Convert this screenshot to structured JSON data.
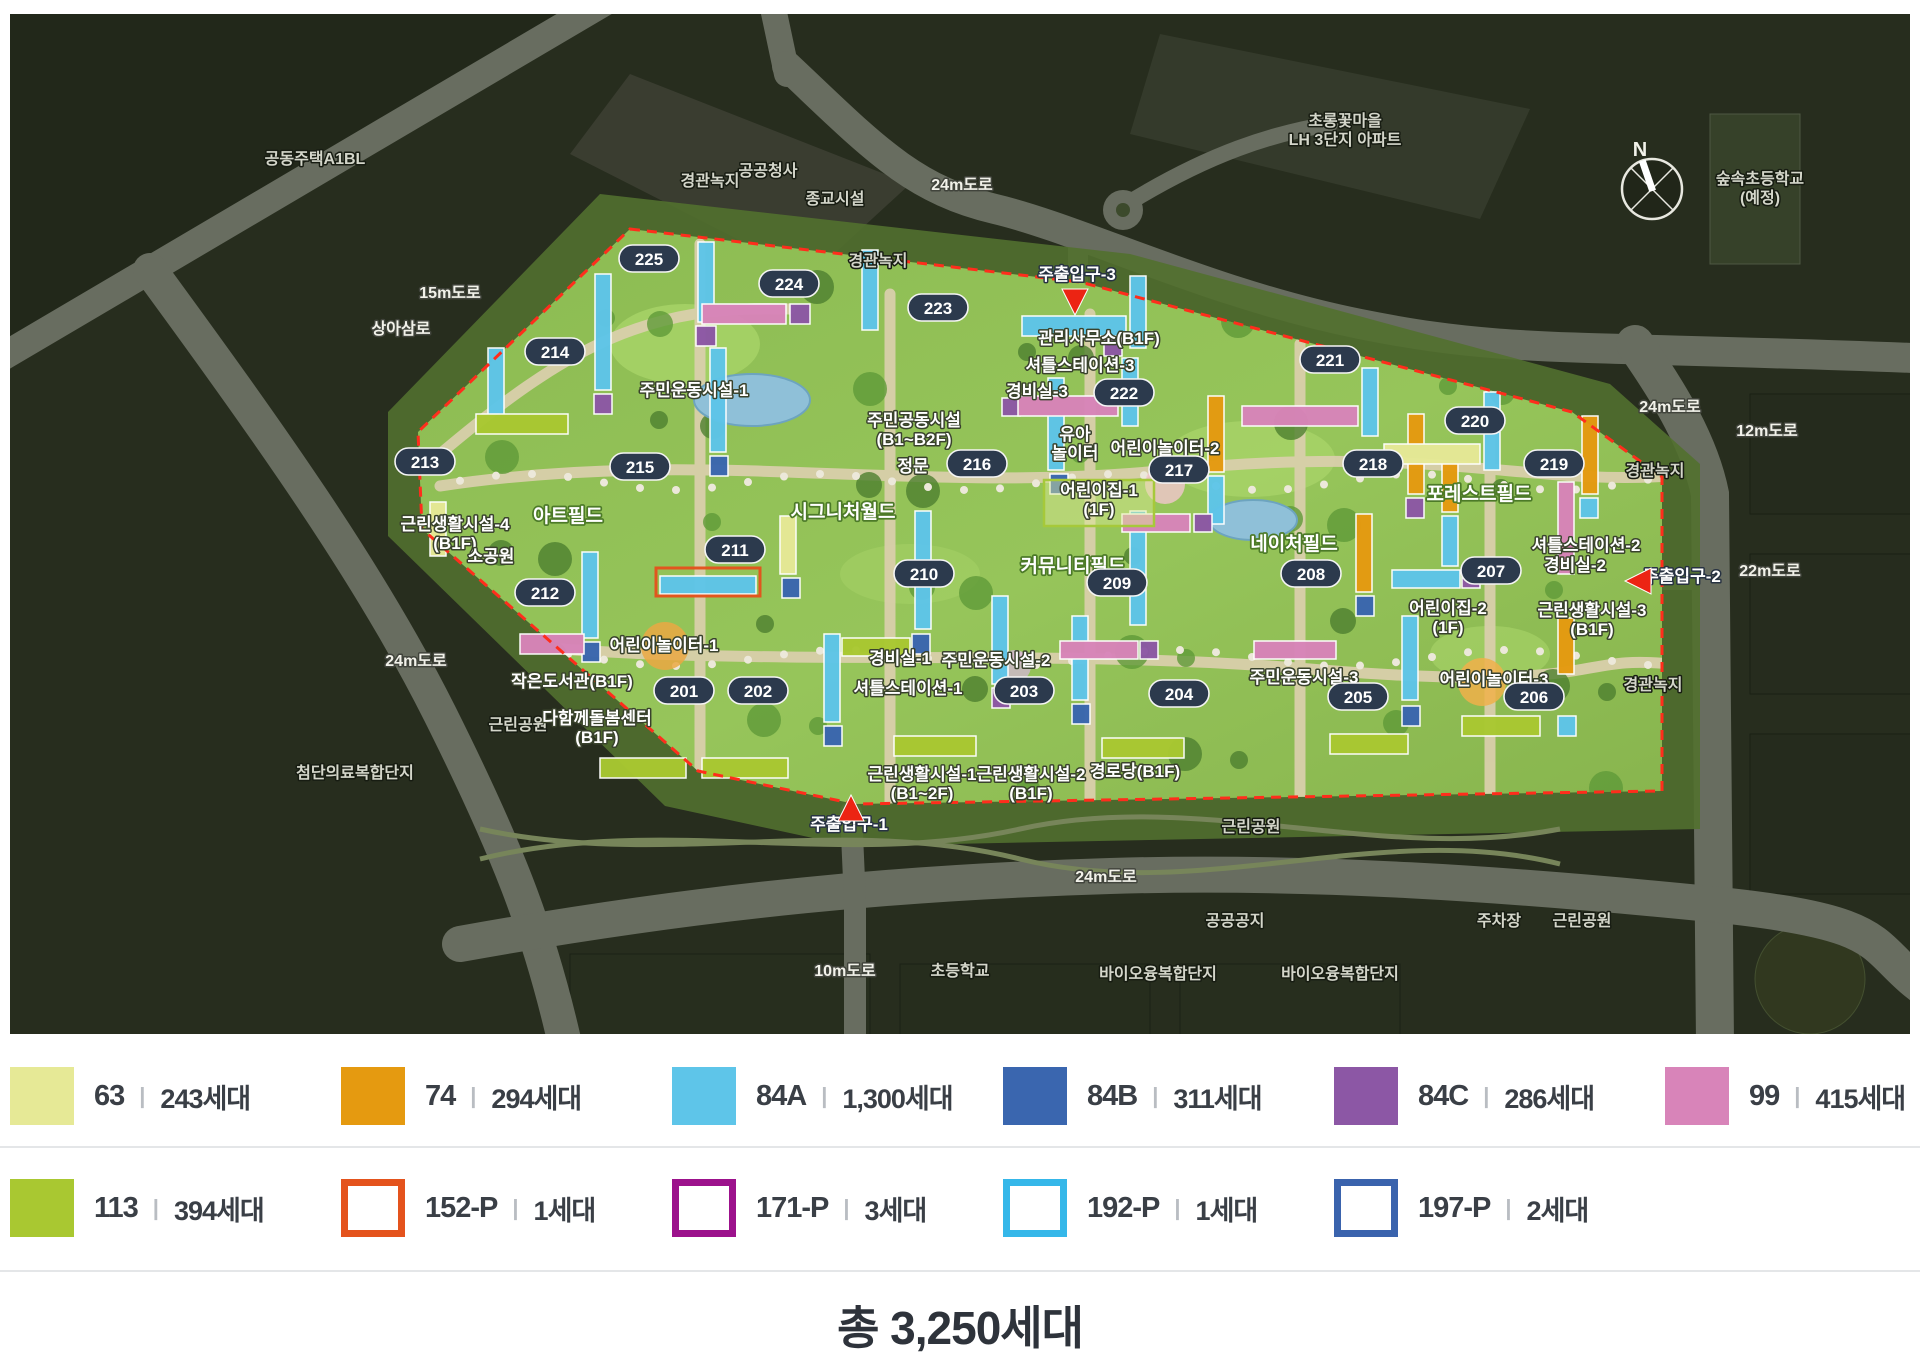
{
  "total": "총 3,250세대",
  "legend": {
    "separator": "|",
    "row1": [
      {
        "label": "63",
        "count": "243세대",
        "color": "#e6e996",
        "type": "fill"
      },
      {
        "label": "74",
        "count": "294세대",
        "color": "#e59a10",
        "type": "fill"
      },
      {
        "label": "84A",
        "count": "1,300세대",
        "color": "#5ec5e9",
        "type": "fill"
      },
      {
        "label": "84B",
        "count": "311세대",
        "color": "#3a66af",
        "type": "fill"
      },
      {
        "label": "84C",
        "count": "286세대",
        "color": "#8c57a5",
        "type": "fill"
      },
      {
        "label": "99",
        "count": "415세대",
        "color": "#d884b9",
        "type": "fill"
      }
    ],
    "row2": [
      {
        "label": "113",
        "count": "394세대",
        "color": "#a9c831",
        "type": "fill"
      },
      {
        "label": "152-P",
        "count": "1세대",
        "color": "#e4531d",
        "type": "outline"
      },
      {
        "label": "171-P",
        "count": "3세대",
        "color": "#9c128c",
        "type": "outline"
      },
      {
        "label": "192-P",
        "count": "1세대",
        "color": "#35b7e9",
        "type": "outline"
      },
      {
        "label": "197-P",
        "count": "2세대",
        "color": "#3a63ad",
        "type": "outline"
      }
    ]
  },
  "map": {
    "boundary_color": "#ff2d1c",
    "badge_color": "#2c3a4d",
    "badges": [
      {
        "n": "201",
        "x": 674,
        "y": 677
      },
      {
        "n": "202",
        "x": 748,
        "y": 677
      },
      {
        "n": "203",
        "x": 1014,
        "y": 677
      },
      {
        "n": "204",
        "x": 1169,
        "y": 680
      },
      {
        "n": "205",
        "x": 1348,
        "y": 683
      },
      {
        "n": "206",
        "x": 1524,
        "y": 683
      },
      {
        "n": "207",
        "x": 1481,
        "y": 557
      },
      {
        "n": "208",
        "x": 1301,
        "y": 560
      },
      {
        "n": "209",
        "x": 1107,
        "y": 569
      },
      {
        "n": "210",
        "x": 914,
        "y": 560
      },
      {
        "n": "211",
        "x": 725,
        "y": 536
      },
      {
        "n": "212",
        "x": 535,
        "y": 579
      },
      {
        "n": "213",
        "x": 415,
        "y": 448
      },
      {
        "n": "214",
        "x": 545,
        "y": 338
      },
      {
        "n": "215",
        "x": 630,
        "y": 453
      },
      {
        "n": "216",
        "x": 967,
        "y": 450
      },
      {
        "n": "217",
        "x": 1169,
        "y": 456
      },
      {
        "n": "218",
        "x": 1363,
        "y": 450
      },
      {
        "n": "219",
        "x": 1544,
        "y": 450
      },
      {
        "n": "220",
        "x": 1465,
        "y": 407
      },
      {
        "n": "221",
        "x": 1320,
        "y": 346
      },
      {
        "n": "222",
        "x": 1114,
        "y": 379
      },
      {
        "n": "223",
        "x": 928,
        "y": 294
      },
      {
        "n": "224",
        "x": 779,
        "y": 270
      },
      {
        "n": "225",
        "x": 639,
        "y": 245
      }
    ],
    "labels": [
      {
        "t": "공동주택A1BL",
        "x": 305,
        "y": 150,
        "v": "dim"
      },
      {
        "t": "공공청사",
        "x": 758,
        "y": 162,
        "v": "dim"
      },
      {
        "t": "종교시설",
        "x": 825,
        "y": 190,
        "v": "dim"
      },
      {
        "t": "경관녹지",
        "x": 700,
        "y": 172,
        "v": "dim"
      },
      {
        "t": "경관녹지",
        "x": 868,
        "y": 252,
        "v": "dim"
      },
      {
        "t": "24m도로",
        "x": 952,
        "y": 176,
        "v": "road"
      },
      {
        "t": "초롱꽃마을\nLH 3단지 아파트",
        "x": 1335,
        "y": 112,
        "v": "dim"
      },
      {
        "t": "숲속초등학교\n(예정)",
        "x": 1750,
        "y": 170,
        "v": "dim"
      },
      {
        "t": "24m도로",
        "x": 1660,
        "y": 398,
        "v": "road"
      },
      {
        "t": "12m도로",
        "x": 1757,
        "y": 422,
        "v": "road"
      },
      {
        "t": "경관녹지",
        "x": 1645,
        "y": 462,
        "v": "dim"
      },
      {
        "t": "22m도로",
        "x": 1760,
        "y": 562,
        "v": "road"
      },
      {
        "t": "경관녹지",
        "x": 1643,
        "y": 676,
        "v": "dim"
      },
      {
        "t": "15m도로",
        "x": 440,
        "y": 284,
        "v": "road"
      },
      {
        "t": "상아삼로",
        "x": 391,
        "y": 320,
        "v": "road"
      },
      {
        "t": "24m도로",
        "x": 406,
        "y": 652,
        "v": "road"
      },
      {
        "t": "첨단의료복합단지",
        "x": 345,
        "y": 764,
        "v": "dim"
      },
      {
        "t": "근린공원",
        "x": 508,
        "y": 716,
        "v": "dim"
      },
      {
        "t": "10m도로",
        "x": 835,
        "y": 962,
        "v": "road"
      },
      {
        "t": "초등학교",
        "x": 950,
        "y": 962,
        "v": "dim"
      },
      {
        "t": "공공공지",
        "x": 1225,
        "y": 912,
        "v": "dim"
      },
      {
        "t": "바이오융복합단지",
        "x": 1148,
        "y": 965,
        "v": "dim"
      },
      {
        "t": "바이오융복합단지",
        "x": 1330,
        "y": 965,
        "v": "dim"
      },
      {
        "t": "주차장",
        "x": 1489,
        "y": 912,
        "v": "dim"
      },
      {
        "t": "근린공원",
        "x": 1572,
        "y": 912,
        "v": "dim"
      },
      {
        "t": "24m도로",
        "x": 1096,
        "y": 868,
        "v": "road"
      },
      {
        "t": "근린공원",
        "x": 1241,
        "y": 818,
        "v": "dim"
      },
      {
        "t": "주민운동시설-1",
        "x": 684,
        "y": 382,
        "v": "fac"
      },
      {
        "t": "주민공동시설\n(B1~B2F)",
        "x": 904,
        "y": 412,
        "v": "fac"
      },
      {
        "t": "정문",
        "x": 903,
        "y": 458,
        "v": "fac"
      },
      {
        "t": "시그니처월드",
        "x": 833,
        "y": 504,
        "v": "field"
      },
      {
        "t": "아트필드",
        "x": 558,
        "y": 508,
        "v": "field"
      },
      {
        "t": "커뮤니티필드",
        "x": 1063,
        "y": 558,
        "v": "field"
      },
      {
        "t": "네이처필드",
        "x": 1284,
        "y": 536,
        "v": "field"
      },
      {
        "t": "포레스트필드",
        "x": 1469,
        "y": 486,
        "v": "field"
      },
      {
        "t": "유아\n놀이터",
        "x": 1065,
        "y": 426,
        "v": "fac"
      },
      {
        "t": "어린이놀이터-2",
        "x": 1155,
        "y": 440,
        "v": "fac"
      },
      {
        "t": "어린이집-1\n(1F)",
        "x": 1089,
        "y": 482,
        "v": "fac",
        "box": true
      },
      {
        "t": "어린이놀이터-1",
        "x": 654,
        "y": 637,
        "v": "fac"
      },
      {
        "t": "어린이놀이터-3",
        "x": 1484,
        "y": 671,
        "v": "fac"
      },
      {
        "t": "작은도서관(B1F)",
        "x": 562,
        "y": 673,
        "v": "fac"
      },
      {
        "t": "다함께돌봄센터\n(B1F)",
        "x": 587,
        "y": 710,
        "v": "fac"
      },
      {
        "t": "근린생활시설-4\n(B1F)",
        "x": 445,
        "y": 516,
        "v": "fac"
      },
      {
        "t": "소공원",
        "x": 481,
        "y": 548,
        "v": "fac"
      },
      {
        "t": "경비실-1",
        "x": 890,
        "y": 650,
        "v": "fac"
      },
      {
        "t": "주민운동시설-2",
        "x": 986,
        "y": 652,
        "v": "fac"
      },
      {
        "t": "셔틀스테이션-1",
        "x": 898,
        "y": 680,
        "v": "fac"
      },
      {
        "t": "근린생활시설-1\n(B1~2F)",
        "x": 912,
        "y": 766,
        "v": "fac"
      },
      {
        "t": "근린생활시설-2\n(B1F)",
        "x": 1021,
        "y": 766,
        "v": "fac"
      },
      {
        "t": "경로당(B1F)",
        "x": 1125,
        "y": 763,
        "v": "fac"
      },
      {
        "t": "주민운동시설-3",
        "x": 1294,
        "y": 669,
        "v": "fac"
      },
      {
        "t": "관리사무소(B1F)",
        "x": 1089,
        "y": 330,
        "v": "fac"
      },
      {
        "t": "셔틀스테이션-3",
        "x": 1070,
        "y": 357,
        "v": "fac"
      },
      {
        "t": "경비실-3",
        "x": 1027,
        "y": 383,
        "v": "fac"
      },
      {
        "t": "셔틀스테이션-2",
        "x": 1576,
        "y": 537,
        "v": "fac"
      },
      {
        "t": "경비실-2",
        "x": 1565,
        "y": 557,
        "v": "fac"
      },
      {
        "t": "어린이집-2\n(1F)",
        "x": 1438,
        "y": 600,
        "v": "fac"
      },
      {
        "t": "근린생활시설-3\n(B1F)",
        "x": 1582,
        "y": 602,
        "v": "fac"
      },
      {
        "t": "주출입구-1",
        "x": 839,
        "y": 816,
        "v": "gate"
      },
      {
        "t": "주출입구-2",
        "x": 1672,
        "y": 568,
        "v": "gate"
      },
      {
        "t": "주출입구-3",
        "x": 1067,
        "y": 266,
        "v": "gate"
      },
      {
        "t": "N",
        "x": 1630,
        "y": 142,
        "v": "compass"
      }
    ],
    "entrances": [
      {
        "dir": "down",
        "x": 1065,
        "y": 288
      },
      {
        "dir": "left",
        "x": 1628,
        "y": 567
      },
      {
        "dir": "up",
        "x": 841,
        "y": 794
      }
    ]
  }
}
